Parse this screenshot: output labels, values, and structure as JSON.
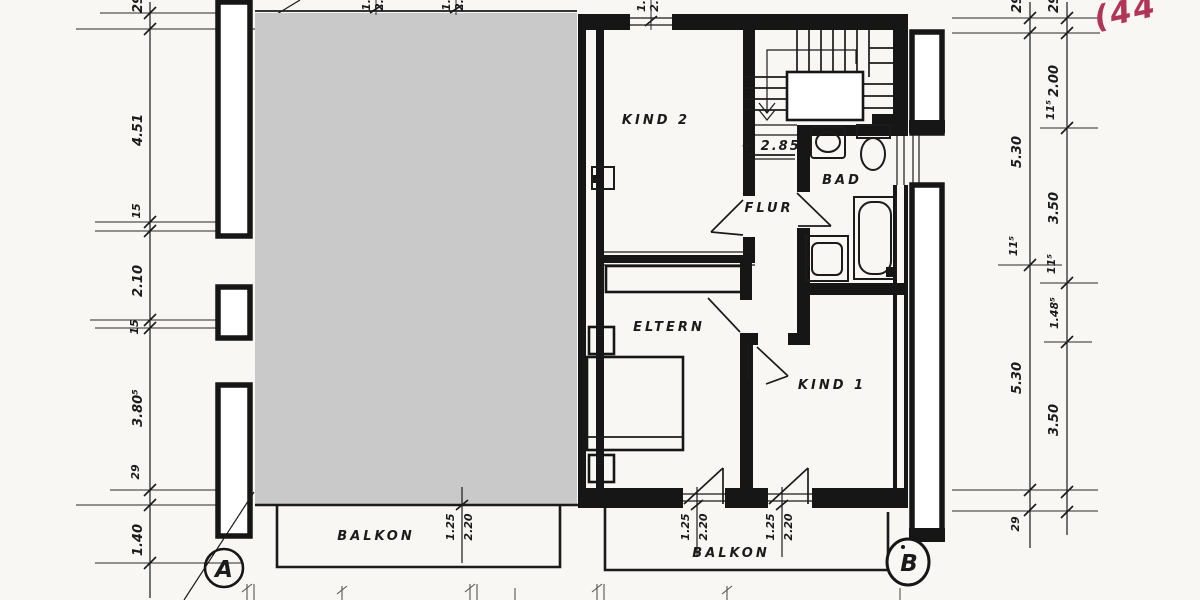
{
  "colors": {
    "paper": "#f8f7f4",
    "ink": "#1b1b1b",
    "redaction_gray": "#c9c9c9",
    "annotation_red": "#b13556"
  },
  "note_red": "(44",
  "rooms": {
    "kind2": "KIND 2",
    "flur": "FLUR",
    "bad": "BAD",
    "eltern": "ELTERN",
    "kind1": "KIND 1"
  },
  "level_label": "+ 2.85",
  "markers": {
    "a": "A",
    "b": "B"
  },
  "balconies": {
    "left": {
      "label": "BALKON",
      "door_width": "1.25",
      "door_height": "2.20"
    },
    "right": {
      "label": "BALKON",
      "door1": {
        "width": "1.25",
        "height": "2.20"
      },
      "door2": {
        "width": "1.25",
        "height": "2.20"
      }
    }
  },
  "dim_left": [
    "29",
    "4.51",
    "15",
    "2.10",
    "15",
    "3.80⁵",
    "29",
    "1.40"
  ],
  "dim_right_outer": [
    "29",
    "5.30",
    "11⁵",
    "5.30",
    "29"
  ],
  "dim_right_inner": [
    "29",
    "2.00",
    "11⁵",
    "3.50",
    "11⁵",
    "1.48⁵",
    "3.50"
  ],
  "window_dims_top": [
    [
      "1.",
      "2."
    ],
    [
      "1.",
      "2."
    ],
    [
      "1.",
      "2."
    ]
  ]
}
